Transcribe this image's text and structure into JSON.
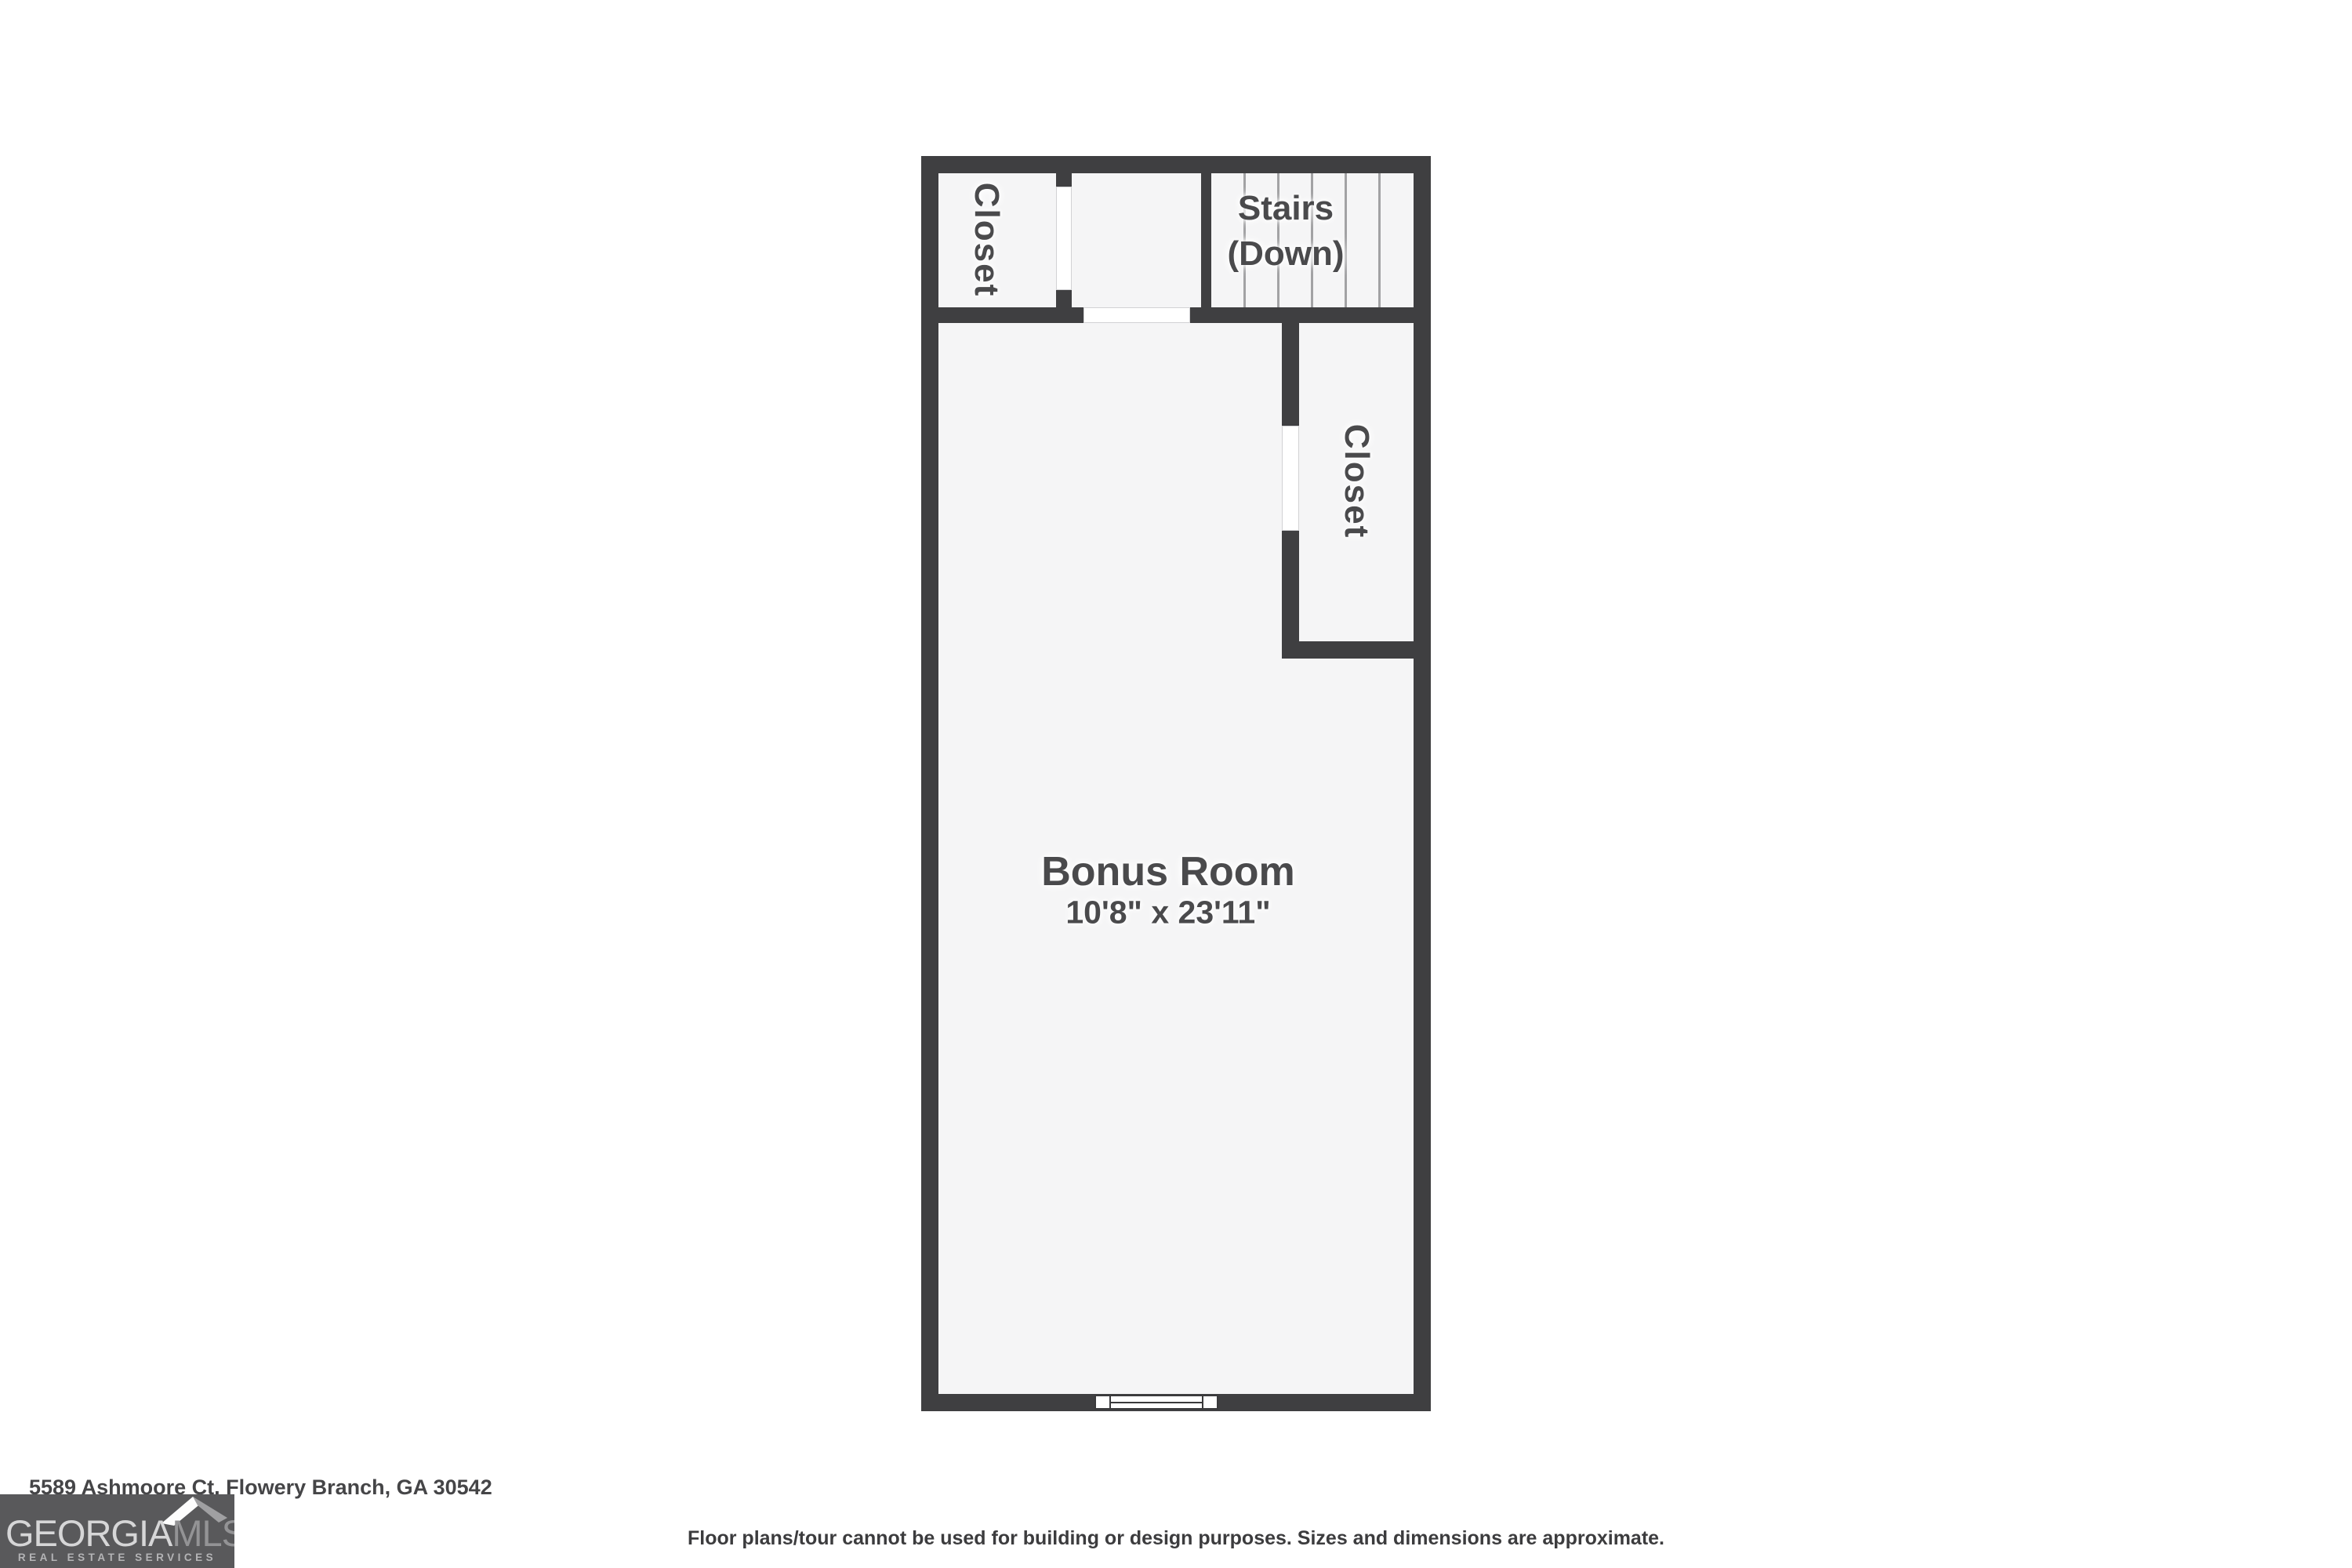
{
  "floorplan": {
    "wall_color": "#3f3f41",
    "floor_color": "#f5f5f6",
    "rooms": {
      "closet_top": {
        "label": "Closet"
      },
      "stairs": {
        "label_line1": "Stairs",
        "label_line2": "(Down)"
      },
      "closet_right": {
        "label": "Closet"
      },
      "bonus_room": {
        "label": "Bonus Room",
        "dimensions": "10'8\" x 23'11\""
      }
    }
  },
  "footer": {
    "address": "5589 Ashmoore Ct, Flowery Branch, GA 30542",
    "disclaimer": "Floor plans/tour cannot be used for building or design purposes. Sizes and dimensions are approximate.",
    "logo": {
      "brand_primary": "GEORGIA",
      "brand_secondary": "MLS",
      "tagline": "REAL ESTATE SERVICES",
      "box_color": "#59595b"
    }
  }
}
